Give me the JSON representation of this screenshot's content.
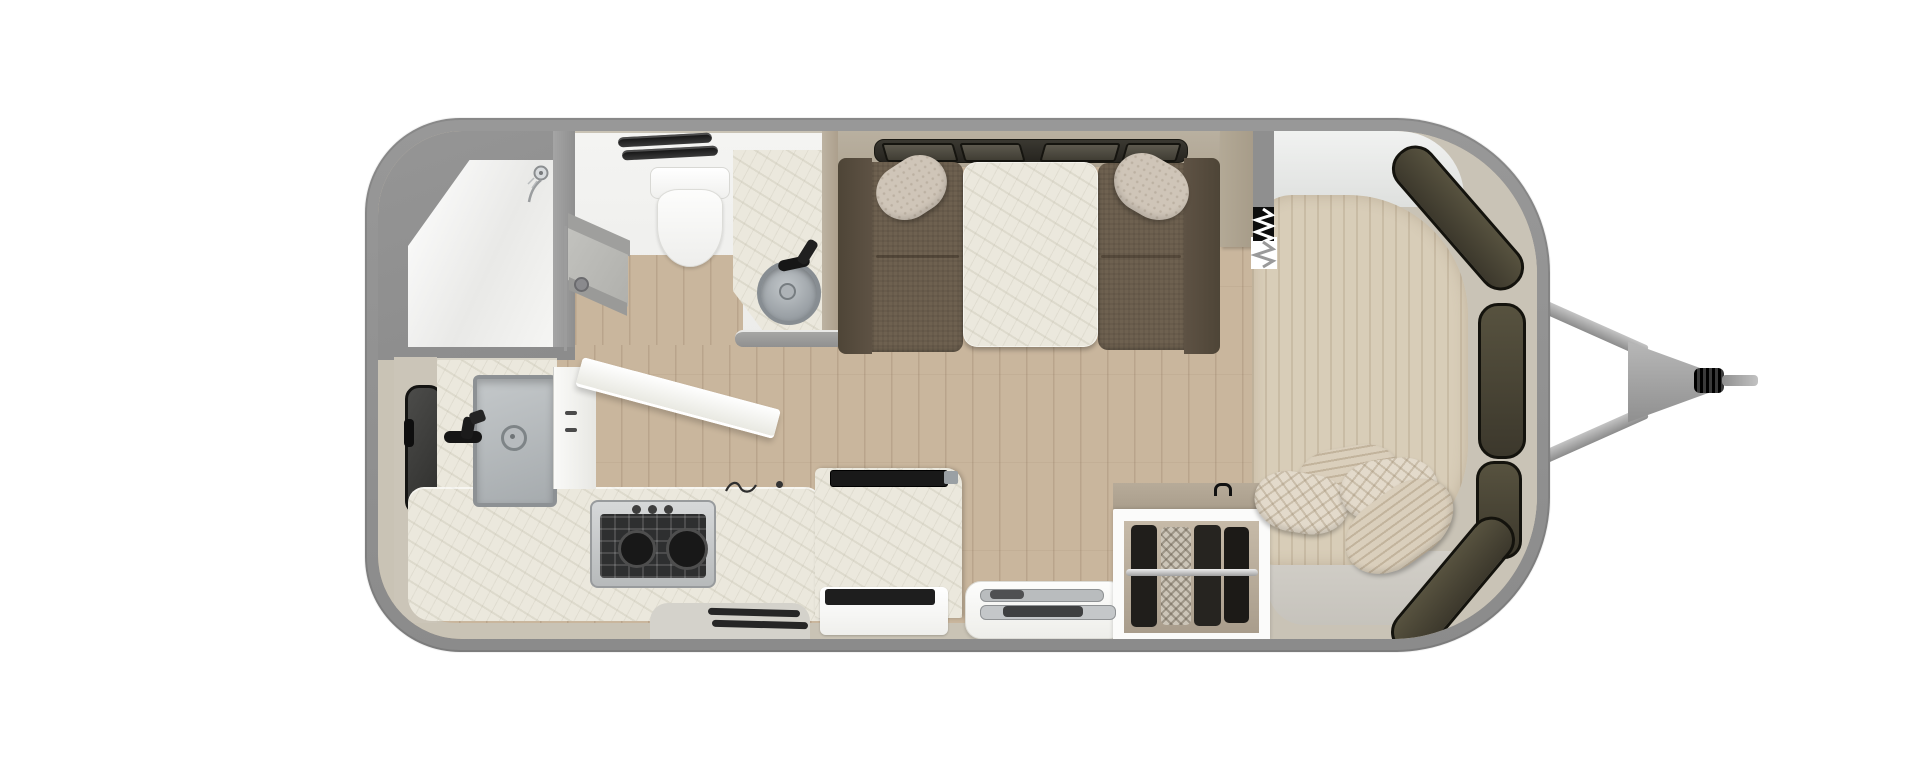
{
  "title": "Travel trailer floor plan — top-down cutaway rendering, hitch at right",
  "palette": {
    "shell_gray": "#8f8f8f",
    "interior_lining": "#c9c3b5",
    "wood_floor": "#c9b69d",
    "marble_counter": "#ebe8dd",
    "bench_fabric": "#6e6150",
    "bedspread": "#d8cdb8",
    "window_dark": "#3c382c",
    "fixture_white": "#f7f7f5"
  },
  "areas": {
    "shower": {
      "label": "Rear corner shower"
    },
    "wet_bath": {
      "label": "Wet bath with toilet and vanity sink"
    },
    "galley": {
      "label": "Galley kitchen with sink, cooktop and flip-up counter"
    },
    "dinette": {
      "label": "Dinette with facing bench seats and table"
    },
    "bedroom": {
      "label": "Front bedroom with wrap-around windows"
    },
    "wardrobe": {
      "label": "Open wardrobe with hanging clothes"
    },
    "hitch": {
      "label": "A-frame tongue and hitch coupler"
    }
  },
  "fixtures": {
    "shower_head": "Shower head",
    "toilet": "Toilet",
    "roof_vent": "Roof vent fan",
    "bath_sink": "Round vanity sink",
    "bath_faucet": "Vanity faucet",
    "bath_door": "Bath privacy door",
    "dinette_window": "Dinette window band",
    "dinette_table": "Dinette table",
    "bench_left": "Dinette bench (left)",
    "bench_right": "Dinette bench (right)",
    "accent_pillow": "Accent pillow",
    "privacy_screen": "Accordion privacy screen",
    "galley_window": "Galley window",
    "galley_faucet": "Galley faucet",
    "galley_sink": "Galley sink",
    "cooktop": "Two-burner gas cooktop",
    "flip_counter": "Flip-up counter extension",
    "fridge": "Refrigerator cabinet",
    "step_vent": "Floor vent",
    "stowed_table": "Stowed folding table",
    "bed": "Bed with striped coverlet",
    "bed_pillow_striped": "Striped pillow",
    "bed_pillow_knit": "Knit pillow",
    "bed_platform": "Bed platform step",
    "front_window": "Front panoramic window segment",
    "clothes_rod": "Wardrobe clothes rod",
    "hitch_arm": "Hitch frame arm",
    "coupler": "Hitch coupler",
    "tongue_jack": "Tongue jack rod"
  }
}
